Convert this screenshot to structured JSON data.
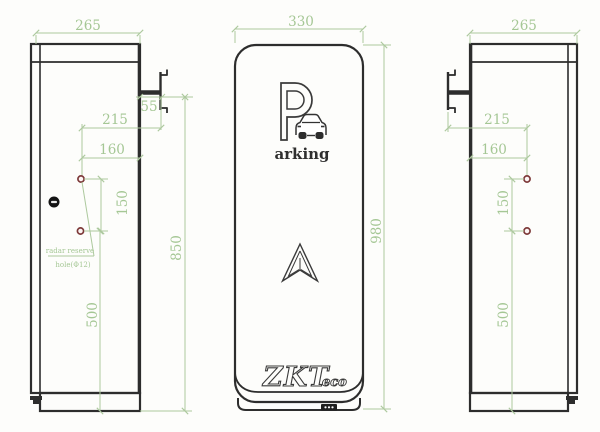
{
  "colors": {
    "dimension_green": "#a9c89b",
    "drawing_dark": "#2d2d2d",
    "hole_red": "#7d3939"
  },
  "left_view": {
    "width": "265",
    "bracket_offset": "55",
    "hole_to_bracket": "215",
    "hole_to_edge": "160",
    "hole_spacing": "150",
    "hole_to_base": "500",
    "overall_height": "850",
    "radar_note_line1": "radar reserve",
    "radar_note_line2": "hole(Φ12)"
  },
  "front_view": {
    "width": "330",
    "height": "980",
    "logo_p": "P",
    "logo_text": "arking",
    "brand": "ZKT",
    "brand_suffix": "eco"
  },
  "right_view": {
    "width": "265",
    "hole_to_bracket": "215",
    "hole_to_edge": "160",
    "hole_spacing": "150",
    "hole_to_base": "500"
  }
}
